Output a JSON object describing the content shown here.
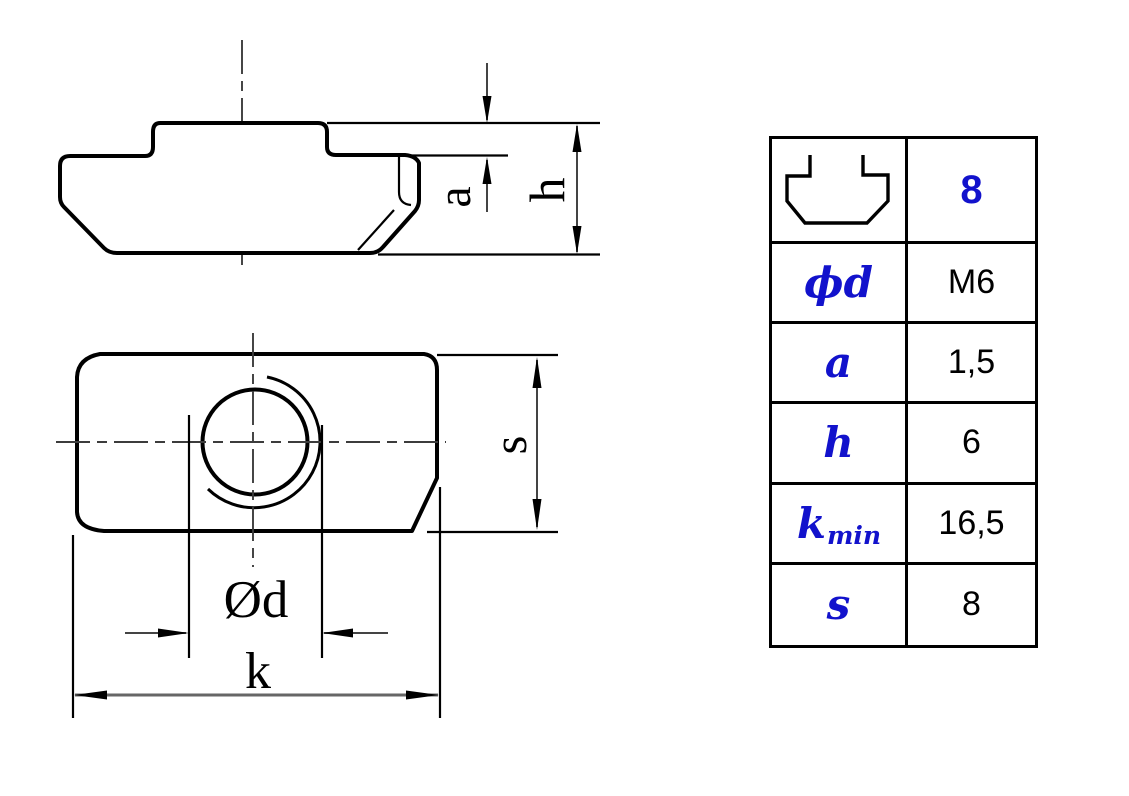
{
  "colors": {
    "accent_blue": "#1212cc",
    "line_black": "#000000",
    "dim_gray": "#666666"
  },
  "spec_table": {
    "profile_icon": "t-slot-profile-icon",
    "size_row": {
      "value": "8"
    },
    "rows": [
      {
        "param": "ϕd",
        "value": "M6"
      },
      {
        "param": "a",
        "value": "1,5"
      },
      {
        "param": "h",
        "value": "6"
      },
      {
        "param": "k",
        "param_sub": "min",
        "value": "16,5"
      },
      {
        "param": "s",
        "value": "8"
      }
    ]
  },
  "drawing": {
    "description": "T-slot nut, two orthographic views",
    "dim_labels": {
      "a": "a",
      "h": "h",
      "s": "s",
      "d": "Ød",
      "k": "k"
    }
  }
}
